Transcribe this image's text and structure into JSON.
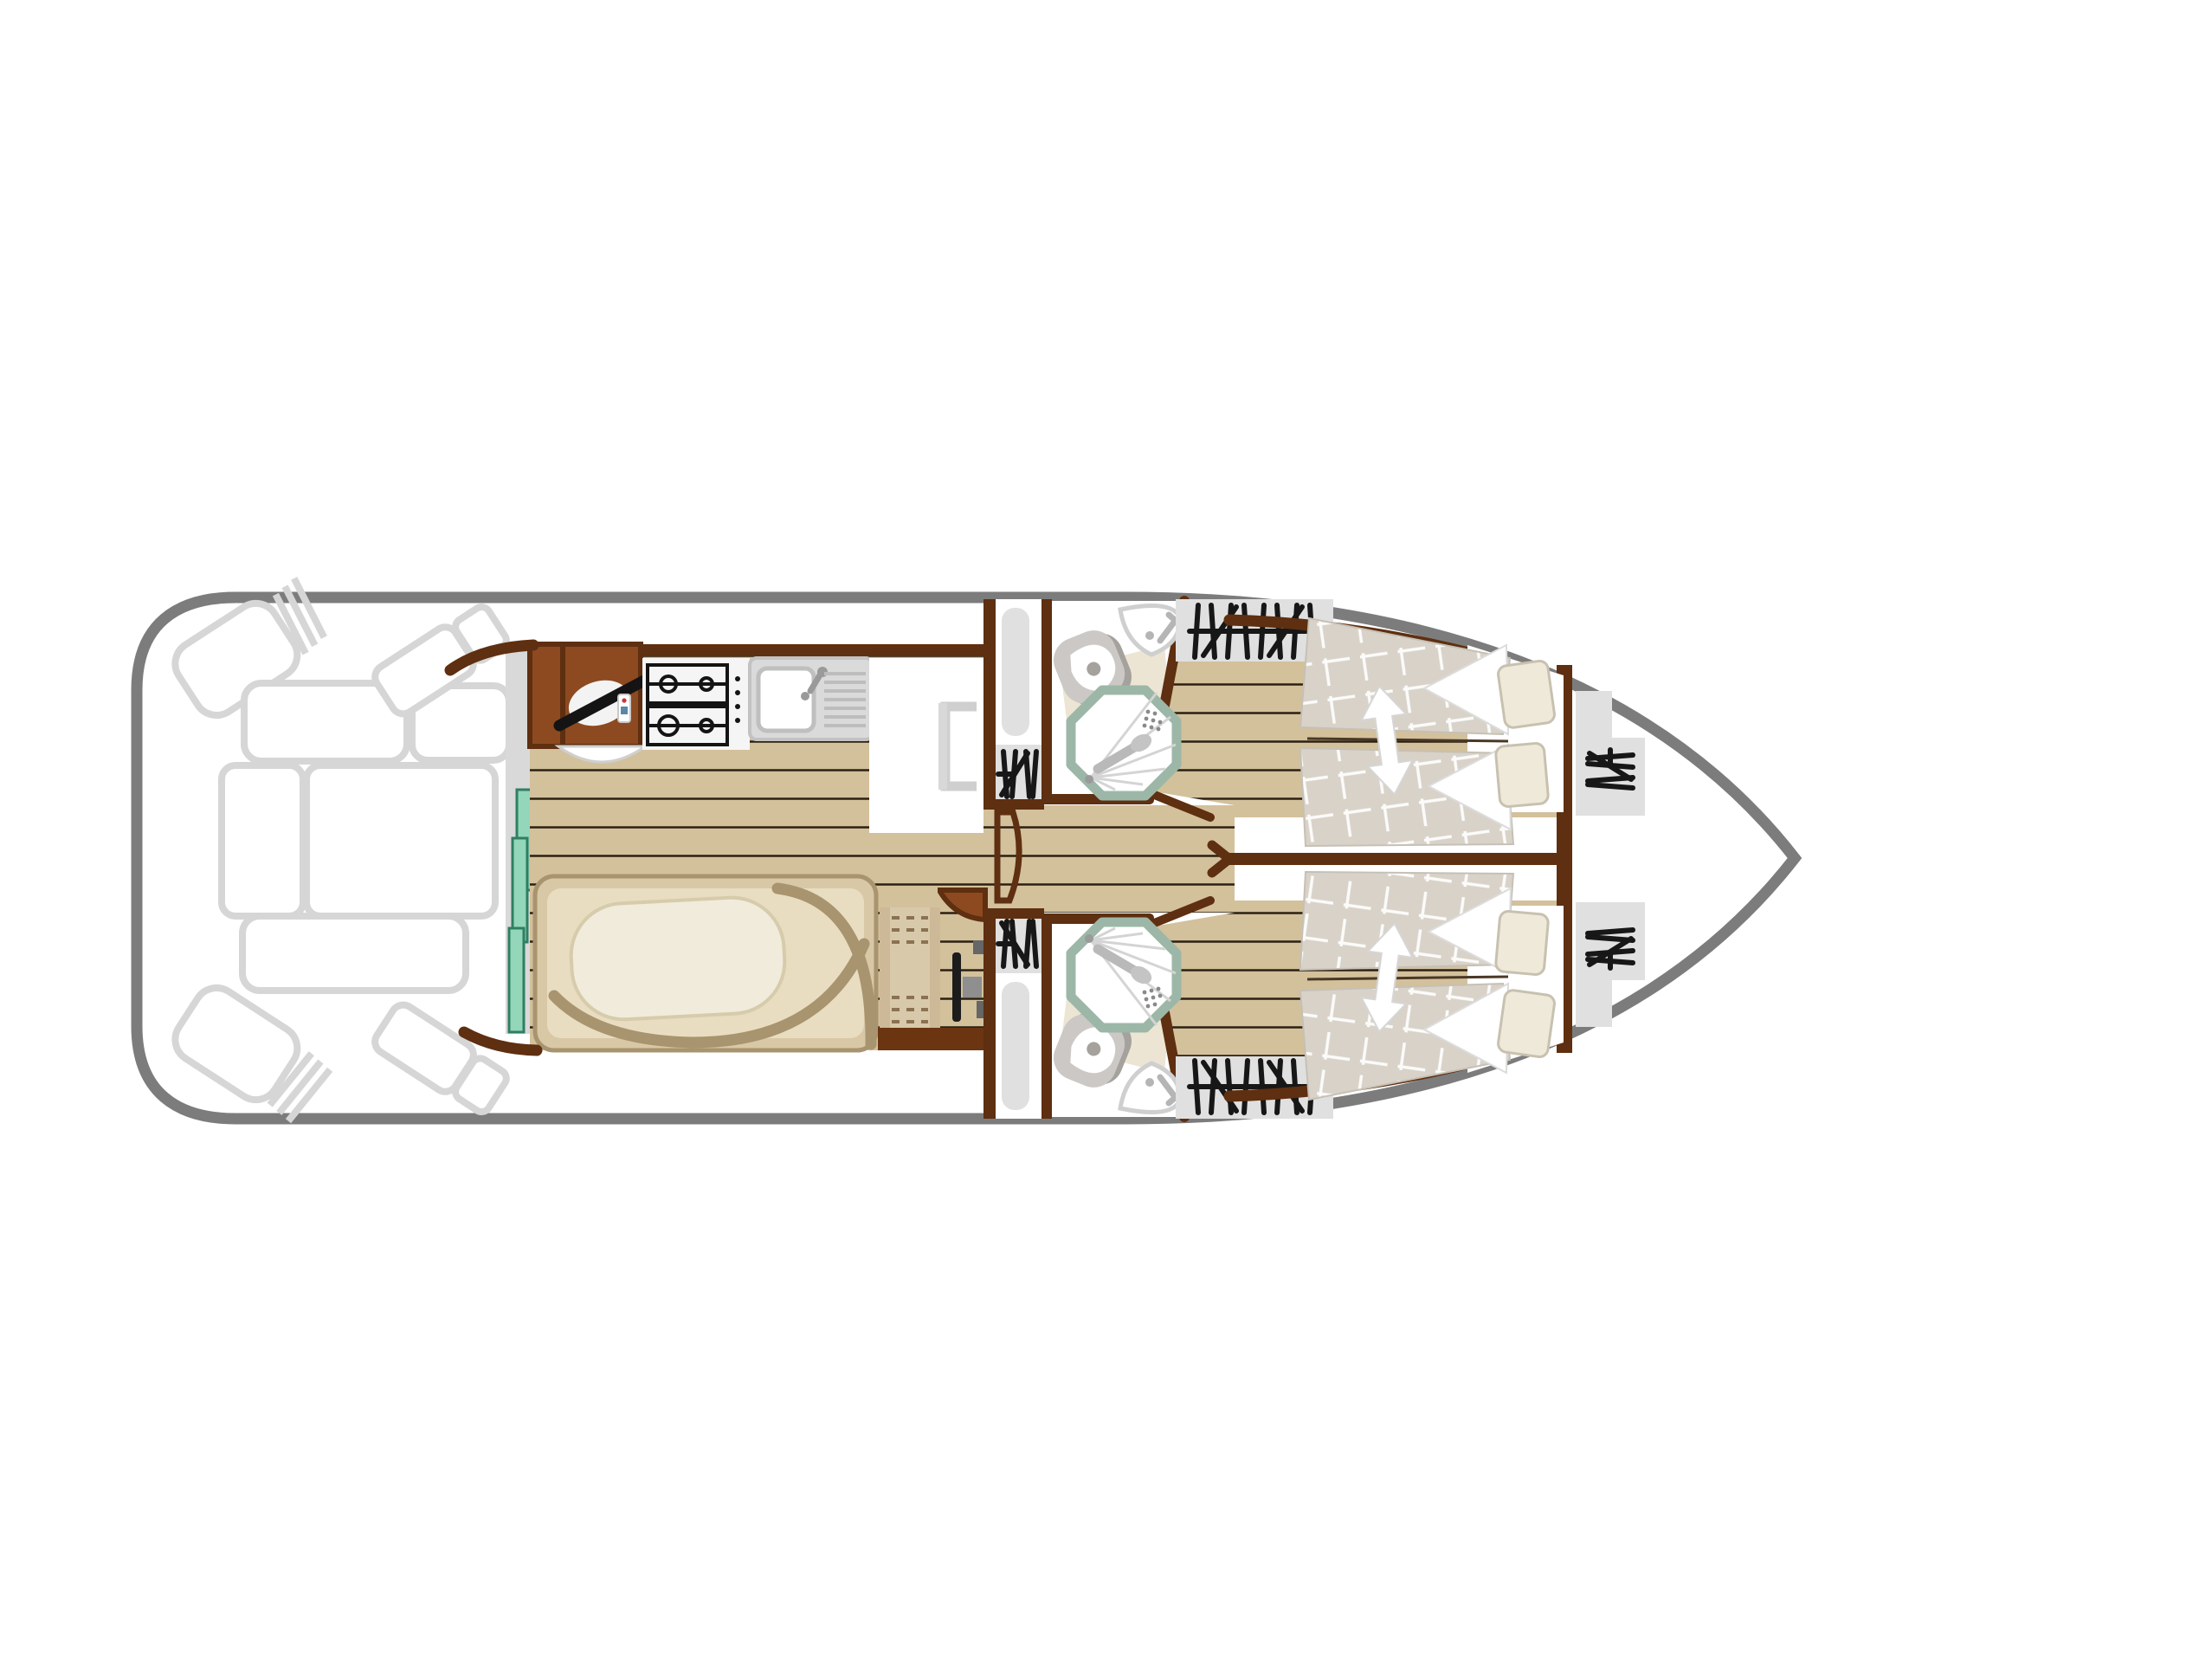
{
  "diagram": {
    "type": "houseboat-deck-floor-plan",
    "orientation": "bow-right-stern-left",
    "rooms": [
      {
        "id": "aft-deck",
        "name": "open aft deck with outlined seating"
      },
      {
        "id": "saloon",
        "name": "saloon with galley, helm station and dinette"
      },
      {
        "id": "corridor",
        "name": "central corridor"
      },
      {
        "id": "bathroom-port",
        "name": "bathroom with shower, toilet, washbasin"
      },
      {
        "id": "bathroom-starboard",
        "name": "bathroom with shower, toilet, washbasin"
      },
      {
        "id": "cabin-port",
        "name": "double cabin with sliding beds"
      },
      {
        "id": "cabin-starboard",
        "name": "double cabin with sliding beds"
      },
      {
        "id": "bow-deck",
        "name": "bow deck with boarding steps"
      }
    ],
    "icons": [
      "steering-wheel-icon",
      "throttle-remote-icon",
      "gas-hob-icon",
      "kitchen-sink-icon",
      "fridge-cabinet-icon",
      "dinette-table-icon",
      "u-bench-icon",
      "sideboard-icon",
      "tv-bracket-icon",
      "sliding-glass-door-icon",
      "wardrobe-hatch-icon",
      "companionway-steps-icon",
      "toilet-icon",
      "corner-washbasin-icon",
      "shower-icon",
      "sliding-bed-icon",
      "pillow-icon",
      "double-arrow-icon",
      "bow-steps-icon",
      "helm-seat-icon"
    ]
  },
  "colors": {
    "hull-stroke": "#7c7c7c",
    "deck-stroke": "#d6d6d6",
    "wall": "#5e2f10",
    "cabinet": "#8d4a20",
    "cabinet-dark": "#6b3512",
    "wood": "#d3c19c",
    "plank": "#2b2012",
    "teal": "#93d6ba",
    "teal-border": "#2f7f62",
    "platform": "#d9d9d9",
    "bench": "#d9c8a6",
    "bench-border": "#a8946e",
    "seat": "#e9ddc1",
    "table": "#f1ebdb",
    "table-border": "#d6cbab",
    "fixture": "#cbc8c5",
    "fixture-dark": "#a5a19d",
    "sage": "#9cb7a7",
    "mat": "#ece5d4",
    "pad": "#e0e0e0",
    "glyph": "#171717",
    "mattress": "#d8d2c8",
    "pillow": "#efe9da",
    "pillow-border": "#c8c1b0",
    "dashline": "#8a7252"
  }
}
